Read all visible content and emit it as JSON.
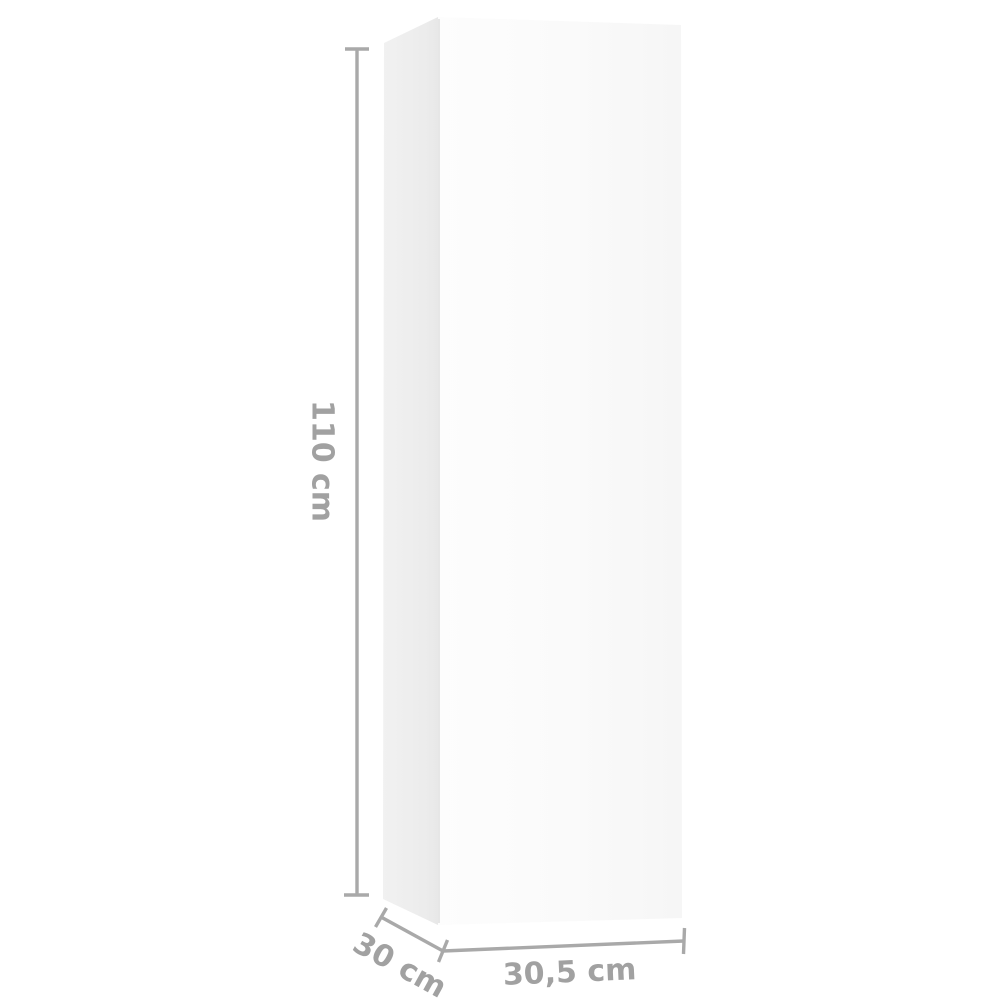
{
  "image": {
    "description": "3D render of a tall white wall-mounted TV cabinet shown with product dimension annotations on a white background",
    "background_color": "#ffffff"
  },
  "cabinet": {
    "front_face_gradient_left": "#fdfdfd",
    "front_face_gradient_right": "#f6f6f6",
    "side_face_gradient_left": "#f1f1f1",
    "side_face_gradient_right": "#e8e8e8",
    "edge_crease_color": "#e2e2e2"
  },
  "dimensions": {
    "line_color": "#a9a9a9",
    "label_color": "#a1a1a1",
    "height_label": "110 cm",
    "depth_label": "30 cm",
    "width_label": "30,5 cm"
  }
}
